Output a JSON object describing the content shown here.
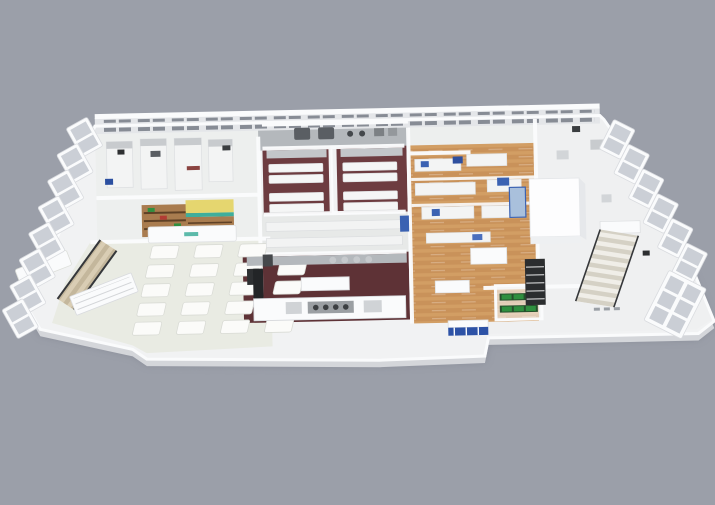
{
  "image": {
    "description": "3D isometric cutaway rendering of a single-storey laboratory and food-processing facility floor plan, viewed from above on a plain grey background",
    "width_px": 715,
    "height_px": 505
  },
  "colors": {
    "bg": "#9b9fa9",
    "slab": "#f1f2f3",
    "slabSide": "#d4d6da",
    "wall": "#fafbfc",
    "wallShade": "#e4e6e9",
    "floorWhite": "#edefee",
    "floorPale": "#e9ebe3",
    "floorRight": "#eff0f1",
    "floorCorridor": "#e7e9e8",
    "maroon": "#6d3c40",
    "maroonDark": "#5e3236",
    "wood": "#c9925a",
    "woodLight": "#dfae72",
    "stainless": "#b4b8bc",
    "steelDark": "#5a5e63",
    "equipDark": "#2e3032",
    "blue": "#3b62b2",
    "blueLight": "#a9c0dc",
    "kioskYellow": "#e5d66f",
    "teal": "#3fae9b",
    "shelfWood": "#a97c4f",
    "plantGreen": "#2f8f3f",
    "plantDark": "#25502c",
    "stairBeige": "#d9cdb4",
    "stairBeigeDark": "#c4b79c",
    "stairWhite": "#f0eee8",
    "stairWhiteDark": "#d5d1c5",
    "railDark": "#35373a",
    "glass": "#c2c7cf",
    "backWin": "#878c95"
  },
  "rooms": [
    {
      "id": "left-labs",
      "label": "White laboratory suites with vertical bench rows"
    },
    {
      "id": "kiosk",
      "label": "Retail shelving kiosk with yellow canopy and teal signage"
    },
    {
      "id": "dining-hall",
      "label": "Open hall with grid of white tables"
    },
    {
      "id": "maroon-lab-1",
      "label": "Test lab with dark maroon floor and white benches"
    },
    {
      "id": "maroon-lab-2",
      "label": "Second test lab with dark maroon floor and white benches"
    },
    {
      "id": "corridor",
      "label": "Central corridor with long white counters"
    },
    {
      "id": "kitchen",
      "label": "Pilot kitchen with maroon floor and stainless equipment"
    },
    {
      "id": "wood-lab",
      "label": "Open-plan lab on wooden floor with blue instruments"
    },
    {
      "id": "white-wing",
      "label": "Right wing of white labs with stair core and elevator block"
    }
  ],
  "features": [
    {
      "id": "back-wall",
      "label": "Rear wall with paired windows"
    },
    {
      "id": "left-windows",
      "label": "Tilted window frames along the left facade"
    },
    {
      "id": "right-windows",
      "label": "Tilted window frames along the right facade"
    },
    {
      "id": "left-staircase",
      "label": "Beige staircase with dark railings"
    },
    {
      "id": "right-staircase",
      "label": "Staircase beside dark storage rack"
    },
    {
      "id": "plant-rack",
      "label": "White rack with green plant trays"
    },
    {
      "id": "core-block",
      "label": "White elevator / service core block"
    }
  ]
}
